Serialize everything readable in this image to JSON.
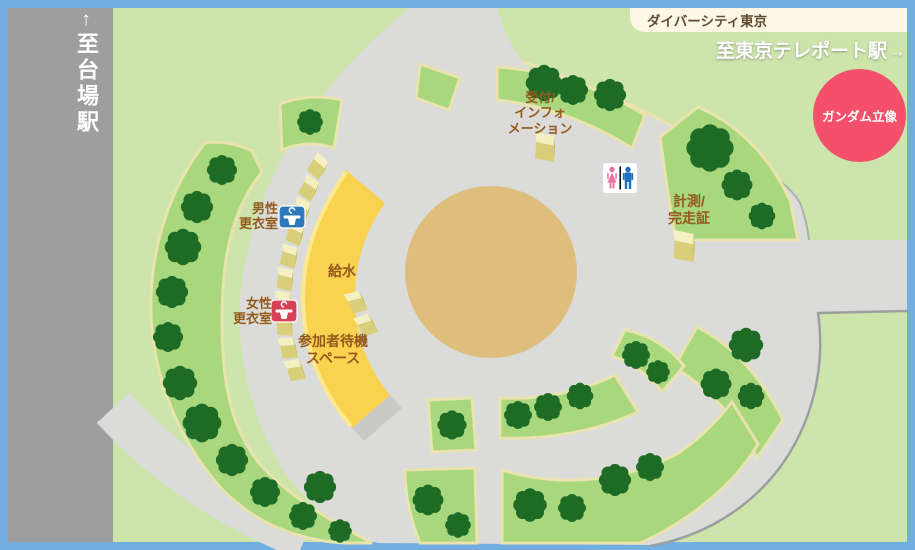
{
  "title": "event venue map",
  "labels": {
    "daiba_arrow": "↑",
    "to_daiba": "至台場駅",
    "divercity": "ダイバーシティ東京",
    "to_teleport": "至東京テレポート駅→",
    "gundam": "ガンダム立像",
    "reception": "受付/\nインフォ\nメーション",
    "mens_room": "男性\n更衣室",
    "womens_room": "女性\n更衣室",
    "water": "給水",
    "waiting_area": "参加者待機\nスペース",
    "timing": "計測/\n完走証"
  },
  "icons": {
    "mens_changing": "hanger-icon",
    "womens_changing": "hanger-icon",
    "restroom": "male-female-restroom-icon"
  },
  "colors": {
    "frame_blue": "#73aee1",
    "background_green": "#cde5ab",
    "ring_road_gray": "#dbdcda",
    "station_road_gray": "#9e9e9e",
    "grass_green": "#a9d77e",
    "grass_border_cream": "#e9e3ae",
    "tree_green": "#1e6b26",
    "plaza_center_tan": "#dfbe7d",
    "waiting_arc_yellow": "#f9d34f",
    "tent_top": "#f4f0c2",
    "tent_front": "#d9cf7b",
    "gundam_red": "#f4506b",
    "label_brown": "#94591d",
    "info_bar_cream": "#fdf8e4",
    "male_blue": "#2e78bc",
    "female_red": "#d84055",
    "restroom_pink": "#f06fa2",
    "restroom_blue": "#1f6fbd"
  }
}
